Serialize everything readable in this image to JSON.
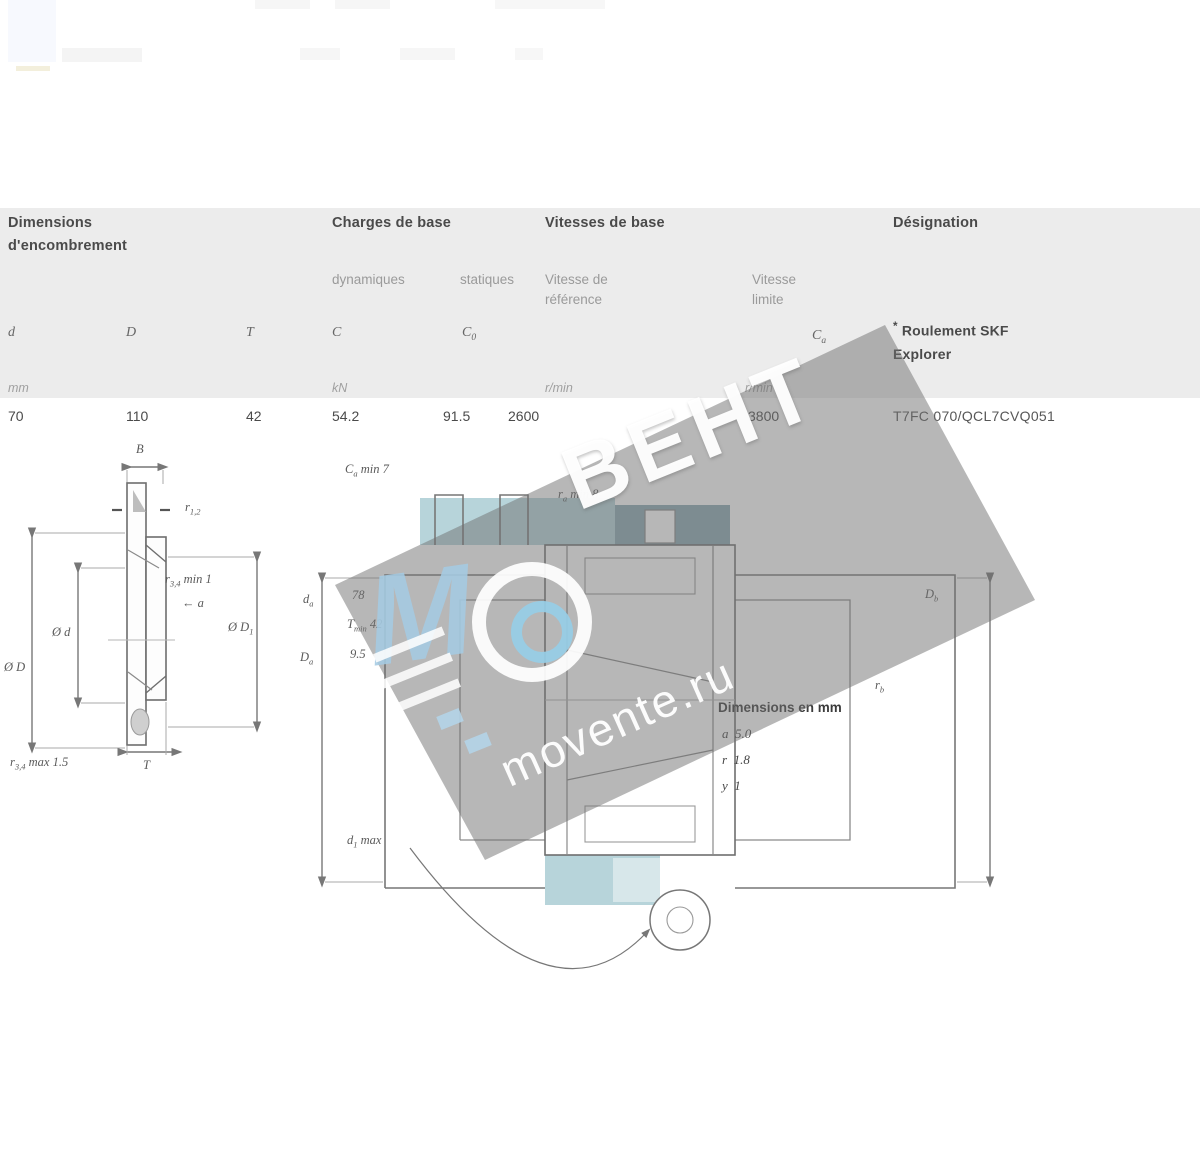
{
  "page": {
    "background": "#ffffff"
  },
  "colors": {
    "header_band": "#ececec",
    "teal_light": "#b7d4da",
    "teal_dark": "#8ba9b3",
    "watermark_gray": "#707070",
    "watermark_blue": "#9fd0e6"
  },
  "table": {
    "group1_title": "Dimensions",
    "group1_sub": "d'encombrement",
    "group2_title": "Charges de base",
    "group3_title": "Vitesses de base",
    "group4_title": "Désignation",
    "col_dynamic": "dynamiques",
    "col_static": "statiques",
    "col_ref_l1": "Vitesse de",
    "col_ref_l2": "référence",
    "col_lim_l1": "Vitesse",
    "col_lim_l2": "limite",
    "sym_d": "d",
    "sym_D": "D",
    "sym_T": "T",
    "sym_C": "C",
    "sym_C0_base": "C",
    "sym_C0_sub": "0",
    "sym_Ca_base": "C",
    "sym_Ca_sub": "a",
    "note_star": "*",
    "note_l1": "Roulement SKF",
    "note_l2": "Explorer",
    "unit_mm": "mm",
    "unit_kn": "kN",
    "unit_rmin1": "r/min",
    "unit_rmin2": "r/min",
    "row": {
      "d": "70",
      "D": "110",
      "T": "42",
      "C": "54.2",
      "C0": "91.5",
      "ref_speed": "2600",
      "limit_speed": "3800",
      "designation": "T7FC 070/QCL7CVQ051"
    }
  },
  "dl": {
    "B": {
      "b": "B",
      "s": "",
      "r": ""
    },
    "r12": {
      "b": "r",
      "s": "1,2",
      "r": ""
    },
    "r34min": {
      "b": "r",
      "s": "3,4",
      "r": " min 1"
    },
    "a": {
      "b": "a",
      "s": "",
      "r": ""
    },
    "diaD": {
      "b": "Ø D",
      "s": "",
      "r": ""
    },
    "diad": {
      "b": "Ø d",
      "s": "",
      "r": ""
    },
    "diaD1": {
      "b": "Ø D",
      "s": "1",
      "r": ""
    },
    "T": {
      "b": "T",
      "s": "",
      "r": ""
    },
    "r34max": {
      "b": "r",
      "s": "3,4",
      "r": " max 1.5"
    }
  },
  "dr": {
    "Ca": {
      "b": "C",
      "s": "a",
      "r": " min 7"
    },
    "ra": {
      "b": "r",
      "s": "a",
      "r": " min 8"
    },
    "da": {
      "b": "d",
      "s": "a",
      "r": ""
    },
    "Da": {
      "b": "D",
      "s": "a",
      "r": ""
    },
    "m1": {
      "b": "",
      "s": "",
      "r": "78"
    },
    "m2": {
      "b": "T",
      "s": "min",
      "r": " 42"
    },
    "m3": {
      "b": "",
      "s": "",
      "r": "9.5"
    },
    "Db": {
      "b": "D",
      "s": "b",
      "r": ""
    },
    "rb": {
      "b": "r",
      "s": "b",
      "r": ""
    },
    "d1max": {
      "b": "d",
      "s": "1",
      "r": " max"
    }
  },
  "note_block": {
    "title": "Dimensions en mm",
    "l1": {
      "b": "a",
      "s": "",
      "r": "  5.0"
    },
    "l2": {
      "b": "r",
      "s": "",
      "r": "  1.8"
    },
    "l3": {
      "b": "y",
      "s": "",
      "r": "  1"
    }
  },
  "watermark": {
    "brand": "ВЕНТ",
    "site": "movente.ru",
    "logo_letter": "M"
  }
}
